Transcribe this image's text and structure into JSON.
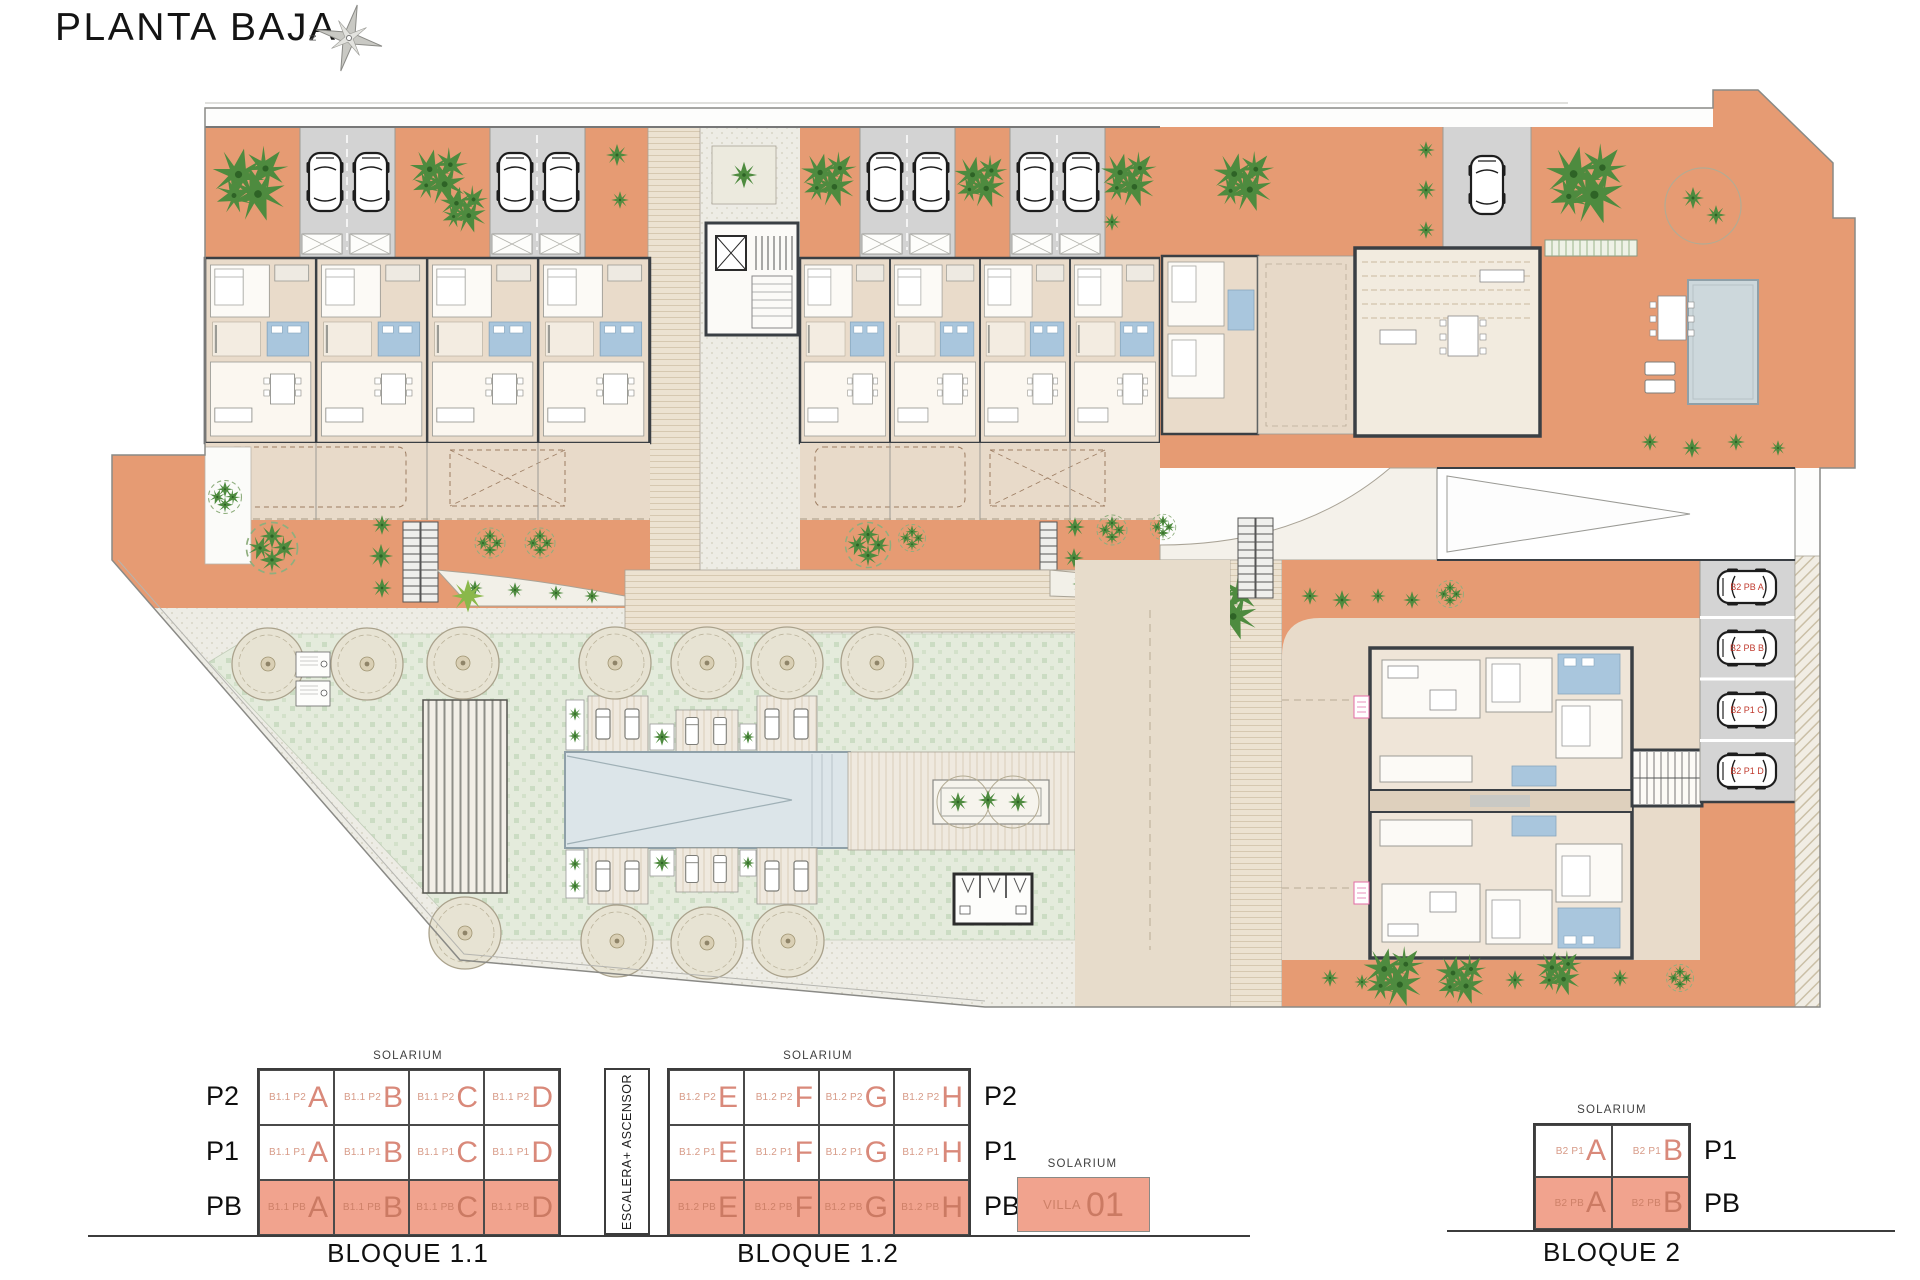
{
  "title": "PLANTA BAJA",
  "compass": {
    "north_label": "N"
  },
  "plan": {
    "parking_space_labels": [
      "B2 PB A",
      "B2 PB B",
      "B2 P1 C",
      "B2 P1 D"
    ]
  },
  "legend": {
    "solarium_label": "SOLARIUM",
    "escalera_label": "ESCALERA+ ASCENSOR",
    "bloque11": {
      "title": "BLOQUE 1.1",
      "rows": [
        {
          "floor": "P2",
          "cells": [
            {
              "code": "B1.1 P2",
              "letter": "A"
            },
            {
              "code": "B1.1 P2",
              "letter": "B"
            },
            {
              "code": "B1.1 P2",
              "letter": "C"
            },
            {
              "code": "B1.1 P2",
              "letter": "D"
            }
          ]
        },
        {
          "floor": "P1",
          "cells": [
            {
              "code": "B1.1 P1",
              "letter": "A"
            },
            {
              "code": "B1.1 P1",
              "letter": "B"
            },
            {
              "code": "B1.1 P1",
              "letter": "C"
            },
            {
              "code": "B1.1 P1",
              "letter": "D"
            }
          ]
        },
        {
          "floor": "PB",
          "cells": [
            {
              "code": "B1.1 PB",
              "letter": "A"
            },
            {
              "code": "B1.1 PB",
              "letter": "B"
            },
            {
              "code": "B1.1 PB",
              "letter": "C"
            },
            {
              "code": "B1.1 PB",
              "letter": "D"
            }
          ]
        }
      ]
    },
    "bloque12": {
      "title": "BLOQUE 1.2",
      "rows": [
        {
          "floor": "P2",
          "cells": [
            {
              "code": "B1.2 P2",
              "letter": "E"
            },
            {
              "code": "B1.2 P2",
              "letter": "F"
            },
            {
              "code": "B1.2 P2",
              "letter": "G"
            },
            {
              "code": "B1.2 P2",
              "letter": "H"
            }
          ]
        },
        {
          "floor": "P1",
          "cells": [
            {
              "code": "B1.2 P1",
              "letter": "E"
            },
            {
              "code": "B1.2 P1",
              "letter": "F"
            },
            {
              "code": "B1.2 P1",
              "letter": "G"
            },
            {
              "code": "B1.2 P1",
              "letter": "H"
            }
          ]
        },
        {
          "floor": "PB",
          "cells": [
            {
              "code": "B1.2 PB",
              "letter": "E"
            },
            {
              "code": "B1.2 PB",
              "letter": "F"
            },
            {
              "code": "B1.2 PB",
              "letter": "G"
            },
            {
              "code": "B1.2 PB",
              "letter": "H"
            }
          ]
        }
      ]
    },
    "villa": {
      "code": "VILLA",
      "number": "01"
    },
    "bloque2": {
      "title": "BLOQUE 2",
      "rows": [
        {
          "floor": "P1",
          "cells": [
            {
              "code": "B2 P1",
              "letter": "A"
            },
            {
              "code": "B2 P1",
              "letter": "B"
            }
          ]
        },
        {
          "floor": "PB",
          "cells": [
            {
              "code": "B2 PB",
              "letter": "A"
            },
            {
              "code": "B2 PB",
              "letter": "B"
            }
          ]
        }
      ]
    }
  },
  "colors": {
    "terracotta": "#e69b73",
    "terrace_beige": "#e8dac9",
    "parking_gray": "#d3d3d3",
    "bath_blue": "#a9c6dd",
    "lawn_green": "#e4ebdc",
    "pool_blue": "#dce5e9",
    "wall_dark": "#3a3f44",
    "legend_salmon": "#f1a38e",
    "legend_text_salmon": "#d9897a",
    "parking_label_red": "#c03a2e",
    "plant_green": "#4e8b3f"
  },
  "icons": {
    "north-compass-icon": "8-point compass star",
    "car-icon": "car top view",
    "palm-tree-icon": "palm leaf burst",
    "round-tree-icon": "circular tree canopy",
    "stairs-icon": "ladder treads",
    "lounger-icon": "sun lounger"
  }
}
